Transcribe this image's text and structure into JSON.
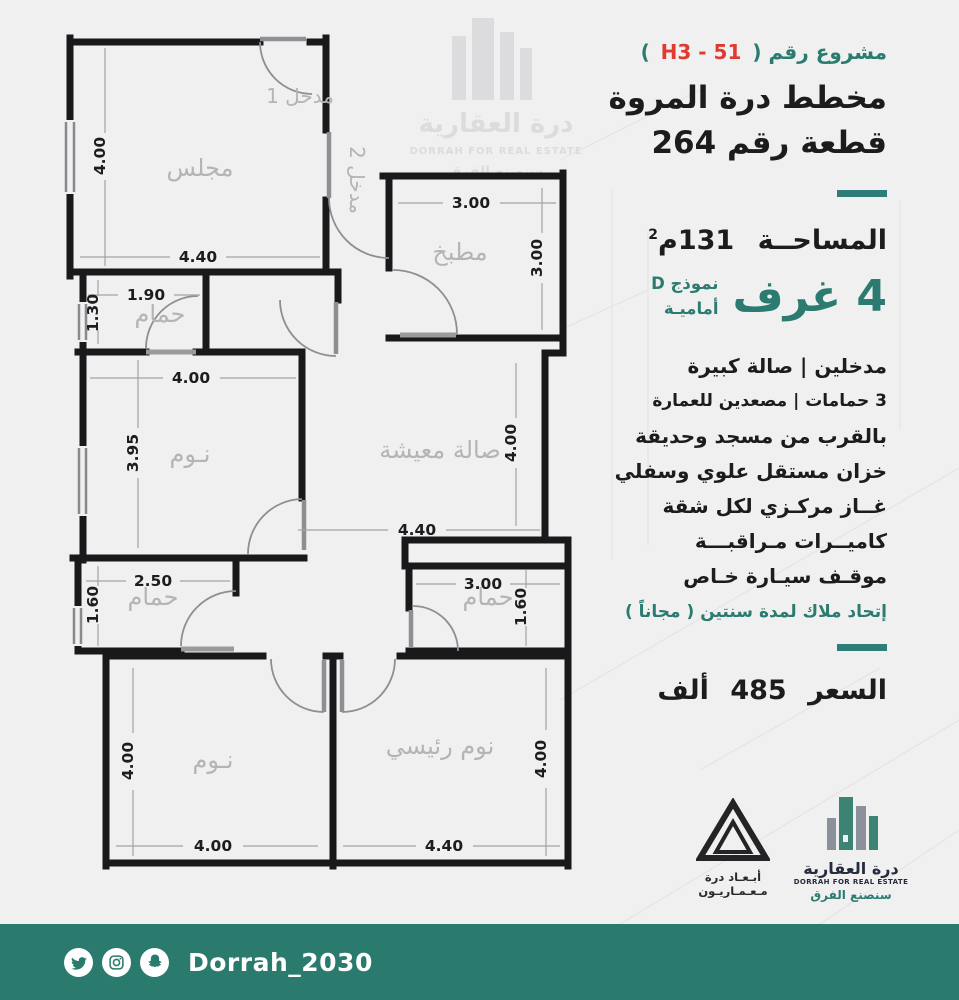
{
  "colors": {
    "accent": "#2b7b70",
    "red": "#e03a30",
    "ink": "#1c1c1e",
    "wall": "#19191b",
    "room_label": "#b4b4b6",
    "footer_bg": "#2b7a6e",
    "watermark": "#dcdcde"
  },
  "panel": {
    "project_prefix": "مشروع رقم (",
    "project_code": "H3 - 51",
    "project_suffix": ")",
    "title_line1": "مخطط درة المروة",
    "title_line2": "قطعة رقم 264",
    "area_label": "المساحــة",
    "area_value": "131م",
    "area_sup": "2",
    "rooms_count": "4 غرف",
    "model_line1": "نموذج D",
    "model_line2": "أماميـة",
    "features": [
      "مدخلين   |   صالة كبيرة",
      "3 حمامات  |  مصعدين للعمارة",
      "بالقرب من مسجد وحديقة",
      "خزان مستقل علوي وسفلي",
      "غــاز مركـزي لكل شقة",
      "كاميــرات مـراقبـــة",
      "موقـف سيـارة خـاص"
    ],
    "hoa_note": "إتحاد ملاك لمدة سنتين ( مجاناً )",
    "price_label": "السعر",
    "price_value": "485",
    "price_unit": "ألف"
  },
  "plan": {
    "labels": {
      "majlis": "مجلس",
      "entrance1": "مدخل 1",
      "entrance2": "مدخل 2",
      "kitchen": "مطبخ",
      "bath": "حمام",
      "bedroom": "نـوم",
      "living": "صالة معيشة",
      "master": "نوم رئيسي"
    },
    "dims": {
      "d440": "4.40",
      "d400": "4.00",
      "d395": "3.95",
      "d300": "3.00",
      "d250": "2.50",
      "d190": "1.90",
      "d160": "1.60",
      "d130": "1.30"
    }
  },
  "watermark": {
    "arabic": "درة العقارية",
    "english": "DORRAH FOR REAL ESTATE",
    "slogan": "سنصنع الفرق"
  },
  "logos": {
    "abaad_line1": "أبـعـاد درة",
    "abaad_line2": "مـعـمـاريـون",
    "dorrah_arabic": "درة العقارية",
    "dorrah_english": "DORRAH FOR REAL ESTATE",
    "dorrah_slogan": "سنصنع الفرق"
  },
  "footer": {
    "handle": "Dorrah_2030"
  }
}
